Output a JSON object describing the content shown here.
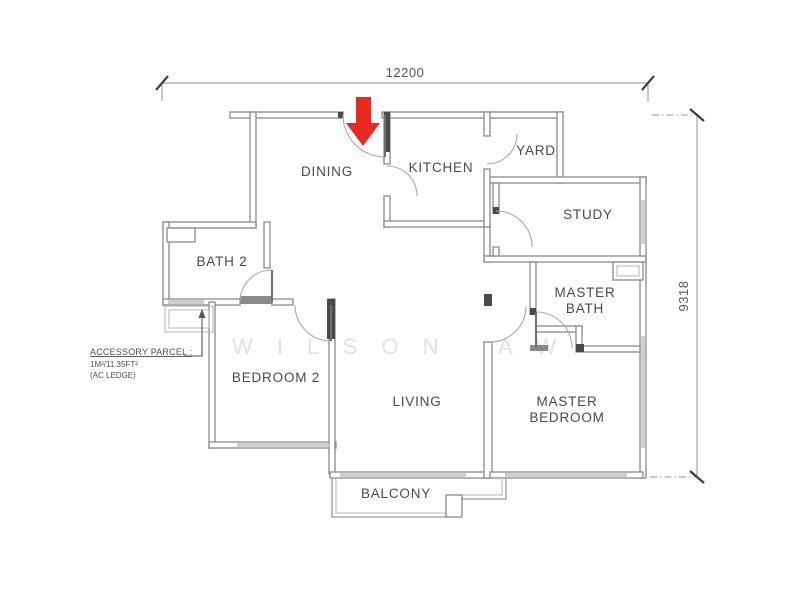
{
  "plan": {
    "rooms": {
      "dining": "DINING",
      "kitchen": "KITCHEN",
      "yard": "YARD",
      "study": "STUDY",
      "bath2": "BATH 2",
      "master_bath_1": "MASTER",
      "master_bath_2": "BATH",
      "bedroom2": "BEDROOM 2",
      "living": "LIVING",
      "master_bedroom_1": "MASTER",
      "master_bedroom_2": "BEDROOM",
      "balcony": "BALCONY"
    },
    "dimensions": {
      "width": "12200",
      "height": "9318"
    },
    "accessory_parcel": {
      "title": "ACCESSORY PARCEL :",
      "area": "1M²/11.35FT²",
      "note": "(AC LEDGE)"
    },
    "watermark": {
      "part1": "W I L S O N",
      "part2": "A W"
    },
    "colors": {
      "entrance_arrow": "#e8291f",
      "walls": "#8a8a8a",
      "columns": "#4a4a4a",
      "label_text": "#4a4a4a",
      "watermark": "#e2e2e2"
    }
  }
}
